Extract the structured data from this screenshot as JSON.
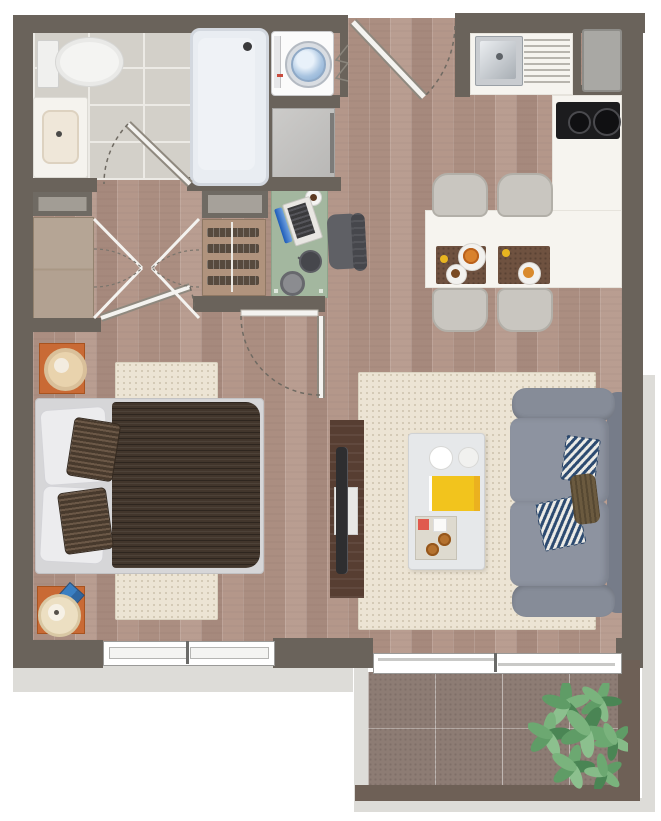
{
  "meta": {
    "title": "Studio apartment floor plan",
    "view": "top-down 3D render",
    "text_on_image": "none"
  },
  "colors": {
    "wall": "#6a635b",
    "balcony_wall": "#6e6056",
    "wood_floor": "#b39689",
    "bath_tile": "#d3d0c9",
    "balcony_tile": "#8d7c74",
    "rug": "#ece4d4",
    "counter": "#f6f4ef",
    "desk": "#a2b69e",
    "sofa": "#868c98",
    "duvet": "#42362c",
    "nightstand": "#c96a35",
    "chevron_pillow": "#2c4a70",
    "book": "#f2c41d",
    "plant": "#5f9c66",
    "exterior_shadow": "#dddcd8"
  },
  "rooms": [
    {
      "id": "bathroom",
      "label": "Bathroom",
      "items": [
        "toilet",
        "vanity sink",
        "bathtub",
        "swing door",
        "tile floor"
      ]
    },
    {
      "id": "laundry",
      "label": "Laundry nook",
      "items": [
        "top-load washing machine",
        "cabinet",
        "bifold marks"
      ]
    },
    {
      "id": "entry",
      "label": "Entry",
      "items": [
        "entry door with swing arc"
      ]
    },
    {
      "id": "kitchen",
      "label": "Kitchen",
      "items": [
        "sink",
        "dish drainer",
        "refrigerator",
        "cooktop with 2 burners",
        "L counter"
      ]
    },
    {
      "id": "dining",
      "label": "Dining bar",
      "items": [
        "white bar table",
        "4 gray chairs",
        "2 brown placemats",
        "plates with food",
        "lemons"
      ]
    },
    {
      "id": "hall",
      "label": "Hallway closets",
      "items": [
        "wardrobe",
        "shelf cabinets",
        "double closet doors",
        "bedroom door"
      ]
    },
    {
      "id": "study",
      "label": "Work corner",
      "items": [
        "green desk",
        "laptop",
        "coffee cup",
        "desk lamp",
        "office chair",
        "dresser"
      ]
    },
    {
      "id": "bedroom",
      "label": "Bedroom",
      "items": [
        "double bed",
        "white pillows",
        "patterned cushions",
        "cream rug",
        "2 orange nightstands",
        "lamp",
        "clock",
        "window"
      ]
    },
    {
      "id": "living",
      "label": "Living room",
      "items": [
        "gray sofa",
        "2 chevron pillows",
        "brown throw",
        "coffee table",
        "yellow book",
        "tray with cookies",
        "tv console",
        "tv",
        "cream rug"
      ]
    },
    {
      "id": "balcony",
      "label": "Balcony",
      "items": [
        "sliding glass door",
        "stone tile floor",
        "green plant"
      ]
    }
  ],
  "counts": {
    "dining_chairs": 4,
    "doors_with_swing_arcs": 4,
    "closet_double_doors": 2,
    "windows": 1,
    "sliding_doors": 1
  }
}
